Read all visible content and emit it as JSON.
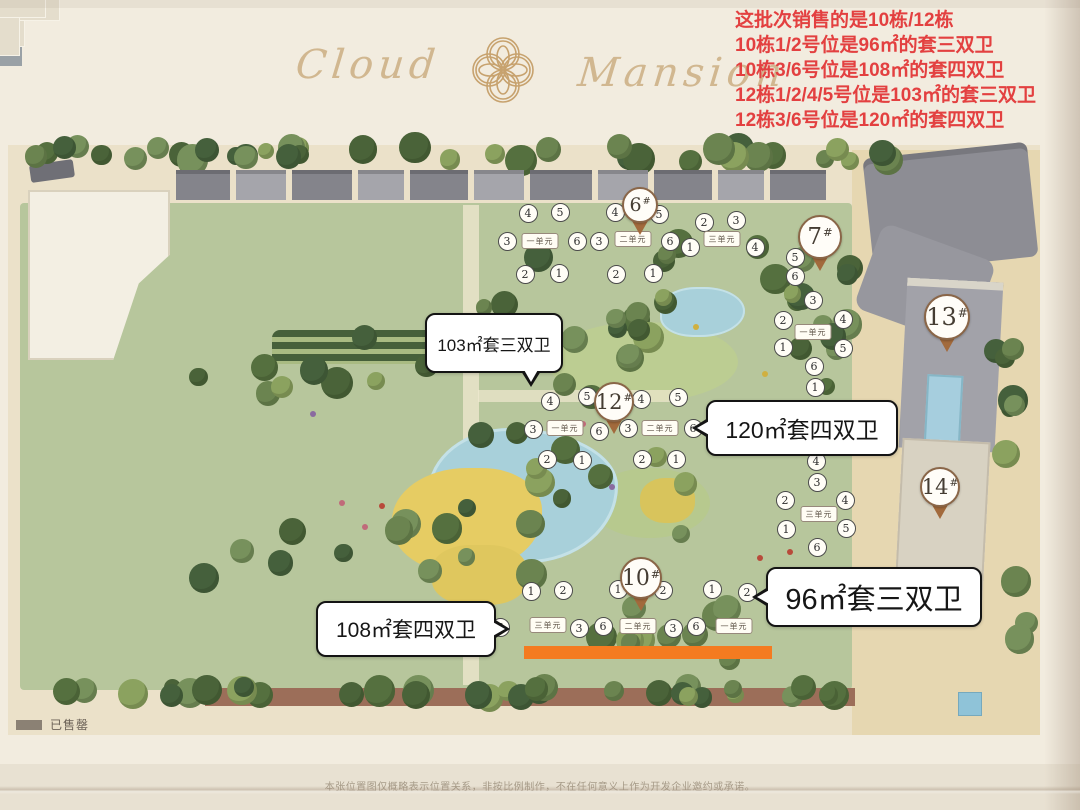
{
  "header": {
    "title_left": "Cloud",
    "title_right": "Mansion",
    "logo": "gold-quatrefoil-flower-emblem"
  },
  "annotation": {
    "color": "#e34040",
    "lines": [
      "这批次销售的是10栋/12栋",
      "10栋1/2号位是96㎡的套三双卫",
      "10栋3/6号位是108㎡的套四双卫",
      "12栋1/2/4/5号位是103㎡的套三双卫",
      "12栋3/6号位是120㎡的套四双卫"
    ]
  },
  "callouts": [
    {
      "id": "callout-103",
      "text": "103㎡套三双卫",
      "x": 425,
      "y": 313,
      "w": 138,
      "h": 60,
      "tail": "bottom",
      "font": 17
    },
    {
      "id": "callout-120",
      "text": "120㎡套四双卫",
      "x": 706,
      "y": 400,
      "w": 192,
      "h": 56,
      "tail": "left",
      "font": 23
    },
    {
      "id": "callout-96",
      "text": "96㎡套三双卫",
      "x": 766,
      "y": 567,
      "w": 216,
      "h": 60,
      "tail": "left",
      "font": 29
    },
    {
      "id": "callout-108",
      "text": "108㎡套四双卫",
      "x": 316,
      "y": 601,
      "w": 180,
      "h": 56,
      "tail": "right",
      "font": 21
    }
  ],
  "pins": [
    {
      "label": "6#",
      "x": 640,
      "y": 205,
      "d": 36
    },
    {
      "label": "7#",
      "x": 820,
      "y": 237,
      "d": 44
    },
    {
      "label": "12#",
      "x": 614,
      "y": 402,
      "d": 40
    },
    {
      "label": "13#",
      "x": 947,
      "y": 317,
      "d": 46
    },
    {
      "label": "10#",
      "x": 641,
      "y": 578,
      "d": 42
    },
    {
      "label": "14#",
      "x": 940,
      "y": 487,
      "d": 40
    }
  ],
  "badges": [
    {
      "n": "4",
      "x": 528,
      "y": 213
    },
    {
      "n": "5",
      "x": 560,
      "y": 212
    },
    {
      "n": "3",
      "x": 507,
      "y": 241
    },
    {
      "n": "6",
      "x": 577,
      "y": 241
    },
    {
      "n": "2",
      "x": 525,
      "y": 274
    },
    {
      "n": "1",
      "x": 559,
      "y": 273
    },
    {
      "n": "4",
      "x": 615,
      "y": 212
    },
    {
      "n": "5",
      "x": 659,
      "y": 214
    },
    {
      "n": "3",
      "x": 599,
      "y": 241
    },
    {
      "n": "6",
      "x": 670,
      "y": 241
    },
    {
      "n": "2",
      "x": 616,
      "y": 274
    },
    {
      "n": "1",
      "x": 653,
      "y": 273
    },
    {
      "n": "2",
      "x": 704,
      "y": 222
    },
    {
      "n": "3",
      "x": 736,
      "y": 220
    },
    {
      "n": "1",
      "x": 690,
      "y": 247
    },
    {
      "n": "4",
      "x": 755,
      "y": 247
    },
    {
      "n": "5",
      "x": 795,
      "y": 257
    },
    {
      "n": "6",
      "x": 795,
      "y": 276
    },
    {
      "n": "4",
      "x": 550,
      "y": 401
    },
    {
      "n": "5",
      "x": 587,
      "y": 396
    },
    {
      "n": "3",
      "x": 533,
      "y": 429
    },
    {
      "n": "6",
      "x": 599,
      "y": 431
    },
    {
      "n": "2",
      "x": 547,
      "y": 459
    },
    {
      "n": "1",
      "x": 582,
      "y": 460
    },
    {
      "n": "4",
      "x": 641,
      "y": 399
    },
    {
      "n": "5",
      "x": 678,
      "y": 397
    },
    {
      "n": "3",
      "x": 628,
      "y": 428
    },
    {
      "n": "6",
      "x": 693,
      "y": 428
    },
    {
      "n": "2",
      "x": 642,
      "y": 459
    },
    {
      "n": "1",
      "x": 676,
      "y": 459
    },
    {
      "n": "1",
      "x": 531,
      "y": 591
    },
    {
      "n": "2",
      "x": 563,
      "y": 590
    },
    {
      "n": "6",
      "x": 500,
      "y": 627
    },
    {
      "n": "3",
      "x": 579,
      "y": 628
    },
    {
      "n": "1",
      "x": 618,
      "y": 589
    },
    {
      "n": "2",
      "x": 663,
      "y": 590
    },
    {
      "n": "6",
      "x": 603,
      "y": 626
    },
    {
      "n": "3",
      "x": 673,
      "y": 628
    },
    {
      "n": "1",
      "x": 712,
      "y": 589
    },
    {
      "n": "2",
      "x": 747,
      "y": 592
    },
    {
      "n": "6",
      "x": 696,
      "y": 626
    },
    {
      "n": "3",
      "x": 813,
      "y": 300
    },
    {
      "n": "2",
      "x": 783,
      "y": 320
    },
    {
      "n": "4",
      "x": 843,
      "y": 319
    },
    {
      "n": "1",
      "x": 783,
      "y": 347
    },
    {
      "n": "5",
      "x": 843,
      "y": 348
    },
    {
      "n": "6",
      "x": 814,
      "y": 366
    },
    {
      "n": "1",
      "x": 815,
      "y": 387
    },
    {
      "n": "4",
      "x": 816,
      "y": 461
    },
    {
      "n": "3",
      "x": 817,
      "y": 482
    },
    {
      "n": "2",
      "x": 785,
      "y": 500
    },
    {
      "n": "4",
      "x": 845,
      "y": 500
    },
    {
      "n": "1",
      "x": 786,
      "y": 529
    },
    {
      "n": "5",
      "x": 846,
      "y": 528
    },
    {
      "n": "6",
      "x": 817,
      "y": 547
    }
  ],
  "unit_labels": [
    {
      "t": "一单元",
      "x": 540,
      "y": 241
    },
    {
      "t": "二单元",
      "x": 633,
      "y": 239
    },
    {
      "t": "三单元",
      "x": 722,
      "y": 239
    },
    {
      "t": "一单元",
      "x": 565,
      "y": 428
    },
    {
      "t": "二单元",
      "x": 660,
      "y": 428
    },
    {
      "t": "三单元",
      "x": 548,
      "y": 625
    },
    {
      "t": "二单元",
      "x": 638,
      "y": 626
    },
    {
      "t": "一单元",
      "x": 734,
      "y": 626
    },
    {
      "t": "一单元",
      "x": 813,
      "y": 332
    },
    {
      "t": "三单元",
      "x": 819,
      "y": 514
    }
  ],
  "sold_highlight": {
    "color": "#f47b20"
  },
  "legend": {
    "label": "已售罄",
    "swatch": "#8b8174"
  },
  "disclaimer": "本张位置图仅概略表示位置关系，非按比例制作，不在任何意义上作为开发企业邀约或承诺。"
}
